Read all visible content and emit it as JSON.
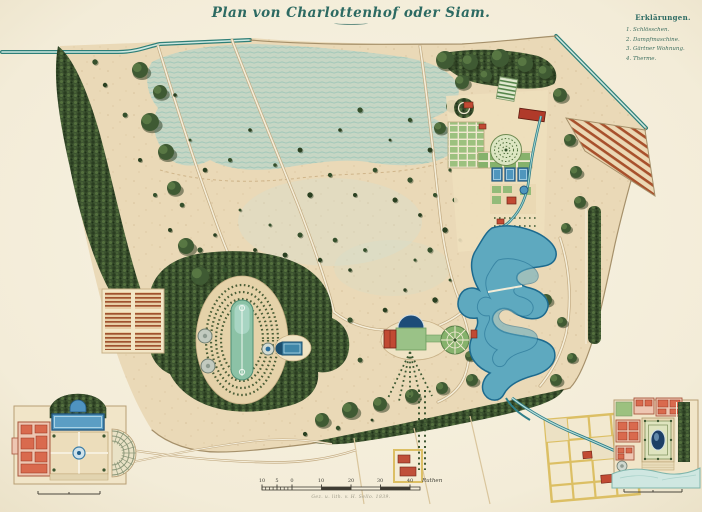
{
  "title": "Plan von Charlottenhof oder Siam.",
  "legend": {
    "heading": "Erklärungen.",
    "items": [
      "1. Schlösschen.",
      "2. Dampfmaschine.",
      "3. Gärtner Wohnung.",
      "4. Therme."
    ]
  },
  "scale": {
    "ticks": [
      "10",
      "5",
      "0",
      "10",
      "20",
      "30",
      "40"
    ],
    "unit": "Ruthen",
    "credit": "Gez. u. lith. v. H. Sello. 1839."
  },
  "colors": {
    "paper": "#f3ecd8",
    "parkland": "#ead9b7",
    "forest": "#3d5430",
    "water": "#5ea9bf",
    "road_teal": "#2e7f78",
    "building_red": "#c14a33",
    "title_ink": "#2c6a62"
  }
}
